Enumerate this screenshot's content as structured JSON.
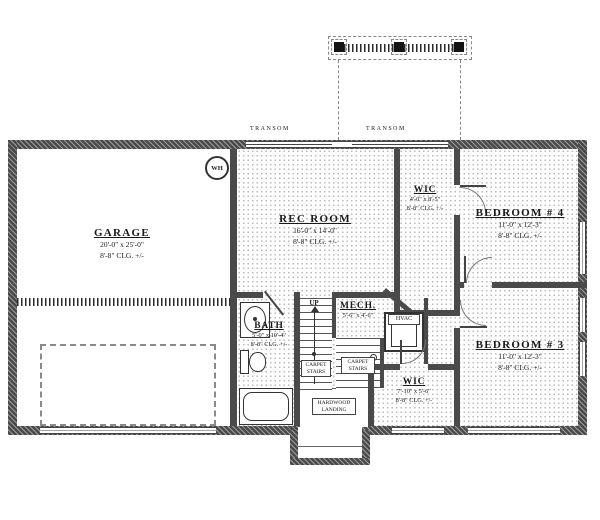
{
  "rooms": {
    "garage": {
      "name": "GARAGE",
      "dims": "20'-0\" x 25'-0\"",
      "clg": "8'-8\" CLG. +/-"
    },
    "rec_room": {
      "name": "REC ROOM",
      "dims": "16'-0\" x 14'-0\"",
      "clg": "8'-8\" CLG. +/-"
    },
    "wic_upper": {
      "name": "WIC",
      "dims": "4'-0\" x 8'-5\"",
      "clg": "8'-8\" CLG. +/-"
    },
    "bedroom_4": {
      "name": "BEDROOM # 4",
      "dims": "11'-0\" x 12'-3\"",
      "clg": "8'-8\" CLG. +/-"
    },
    "bedroom_3": {
      "name": "BEDROOM # 3",
      "dims": "11'-0\" x 12'-3\"",
      "clg": "8'-8\" CLG. +/-"
    },
    "wic_lower": {
      "name": "WIC",
      "dims": "7'-10\" x 5'-6\"",
      "clg": "8'-8\" CLG. +/-"
    },
    "bath": {
      "name": "BATH",
      "dims": "5'-0\" x 10'-4\"",
      "clg": "8'-8\" CLG. +/-"
    },
    "mech": {
      "name": "MECH.",
      "dims": "5'-6\" x 4'-6\""
    }
  },
  "annotations": {
    "transom_left": "TRANSOM",
    "transom_right": "TRANSOM",
    "up": "UP",
    "water_heater": "WH",
    "hvac": "HVAC",
    "stairs_note_left": "CARPET STAIRS",
    "stairs_note_right": "CARPET STAIRS",
    "landing_note": "HARDWOOD LANDING"
  },
  "colors": {
    "wall": "#4a4a4a",
    "line": "#333333",
    "floor_dot": "#b9b9b9",
    "background": "#ffffff"
  }
}
